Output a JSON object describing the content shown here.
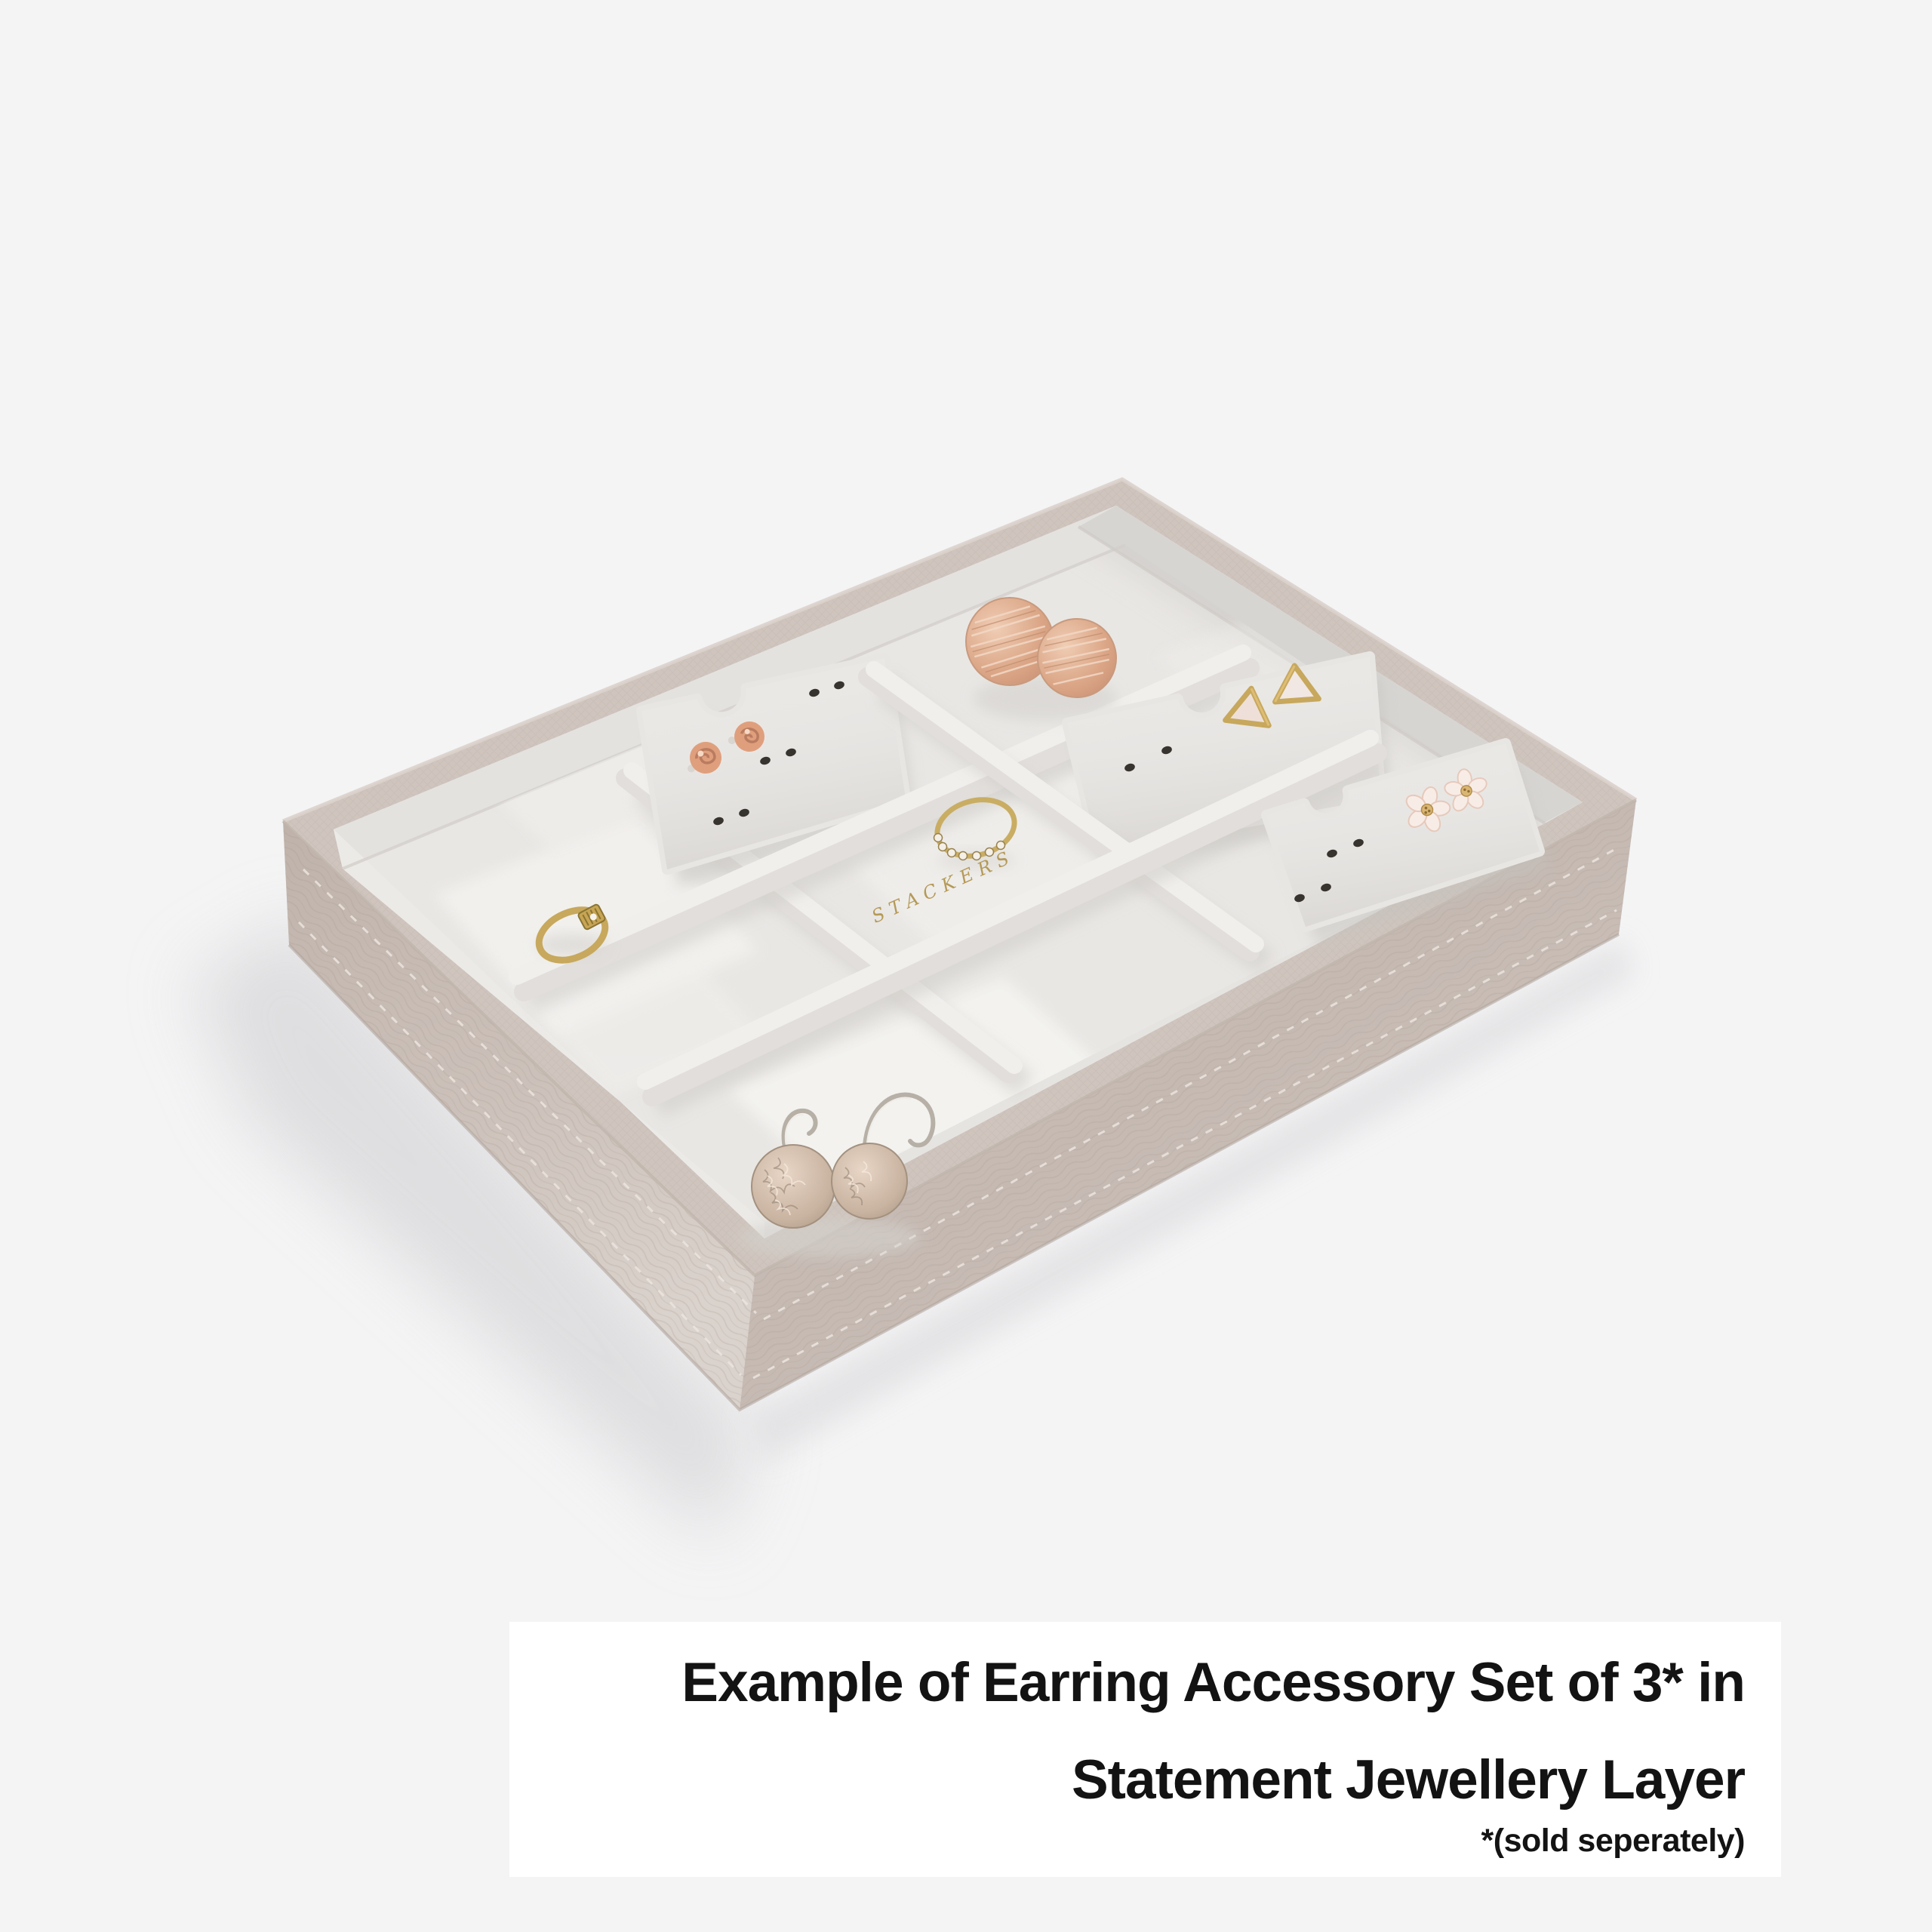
{
  "image_type": "product photograph",
  "caption": {
    "line1": "Example of Earring Accessory Set of 3* in",
    "line2": "Statement Jewellery Layer",
    "footnote": "*(sold seperately)",
    "box_color": "#ffffff",
    "text_color": "#131313"
  },
  "product": {
    "name": "Statement Jewellery Layer tray with Earring Accessory Set of 3",
    "brand_logo_text": "STACKERS",
    "compartment_count": 9,
    "earring_card_count": 3,
    "exterior_finish": "taupe saffiano-texture leatherette",
    "lining_finish": "light grey velvet",
    "items": [
      {
        "name": "rose-stud-earrings",
        "desc": "rose gold flower rose studs on earring card 1",
        "color": "#df9f7d"
      },
      {
        "name": "disc-stud-earrings",
        "desc": "brushed rose gold disc studs leaning on back wall",
        "color": "#dfa98c"
      },
      {
        "name": "triangle-stud-earrings",
        "desc": "gold-edged pearl triangle studs on earring card 2",
        "color": "#efe2da"
      },
      {
        "name": "petal-stud-earrings",
        "desc": "small gold petal studs",
        "color": "#b5a148"
      },
      {
        "name": "flower-stud-earrings",
        "desc": "blush enamel flower studs on earring card 3",
        "color": "#f8ece6"
      },
      {
        "name": "signet-ring",
        "desc": "gold ring with engraved plaque, left compartment",
        "color": "#c7a85c"
      },
      {
        "name": "crystal-ring",
        "desc": "gold ring with crystal band, centre compartment",
        "color": "#c9ad63"
      },
      {
        "name": "drop-earrings",
        "desc": "champagne textured disc drop earrings, front compartment",
        "color": "#cbb7a8"
      }
    ]
  },
  "palette": {
    "background": "#f4f4f5",
    "tray_taupe": "#c9beb7",
    "tray_taupe_dark": "#b9aca4",
    "tray_taupe_light": "#d9d1cb",
    "rim_top": "#cfc5be",
    "velvet_floor": "#e9e7e4",
    "velvet_wall": "#e4e2df",
    "velvet_wall_shaded": "#d7d5d2",
    "divider_top": "#f1efec",
    "divider_side": "#e1dedb",
    "card": "#e8e6e3",
    "hole": "#37332e",
    "gold": "#c7a85c",
    "gold_deep": "#93802f",
    "rose_gold": "#df9f7d",
    "rose_gold_light": "#f4d7c2",
    "champagne": "#cbb7a8",
    "logo_gold": "#b29650",
    "shadow": "#d9d9db"
  }
}
